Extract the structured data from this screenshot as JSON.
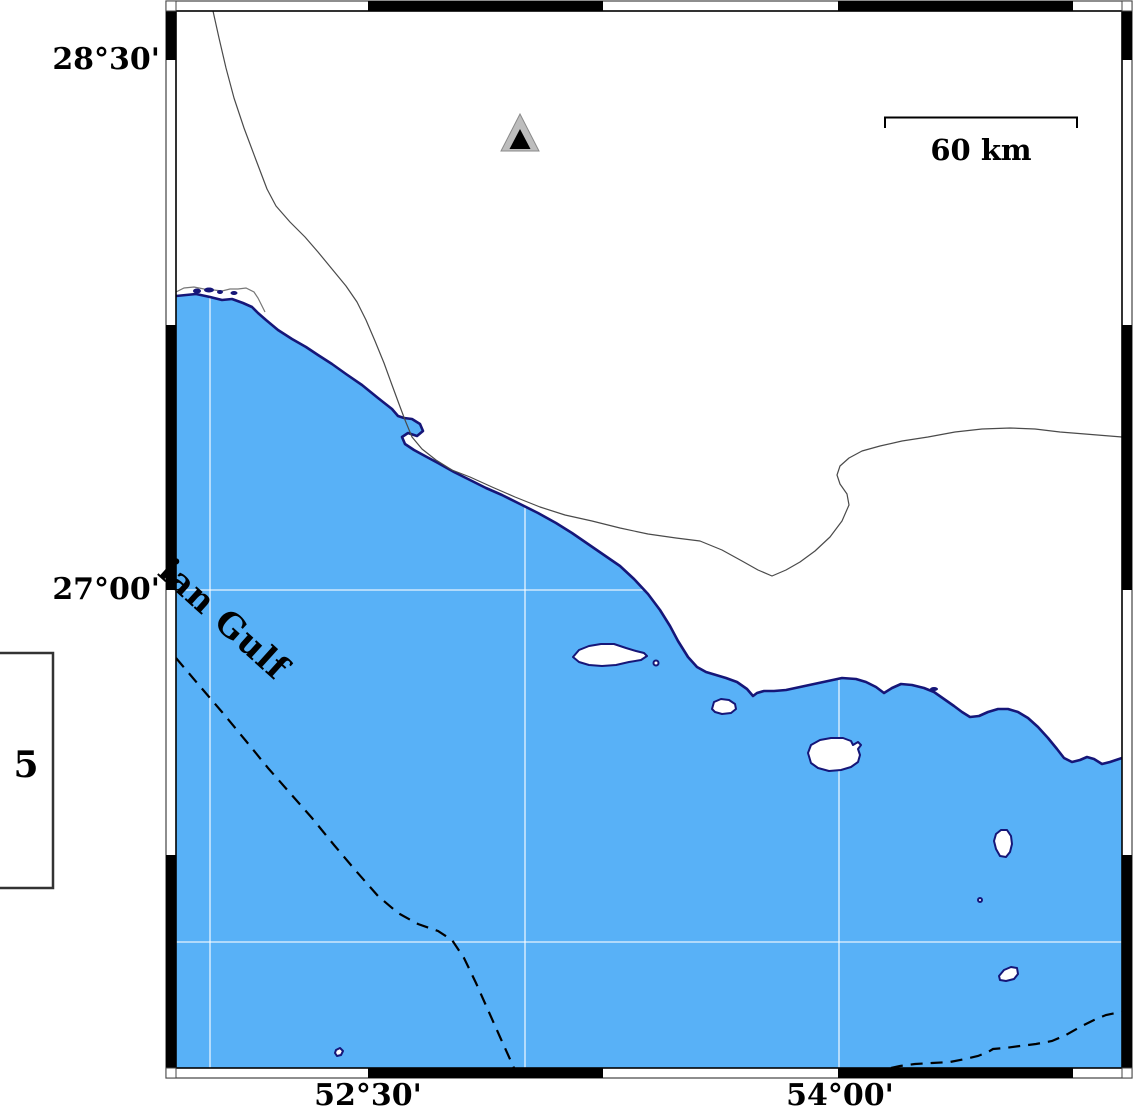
{
  "frame": {
    "lat_labels": [
      {
        "text": "28°30'"
      },
      {
        "text": "27°00'"
      }
    ],
    "lon_labels": [
      {
        "text": "52°30'"
      },
      {
        "text": "54°00'"
      }
    ]
  },
  "sea": {
    "name_label": "ian Gulf"
  },
  "scale_bar": {
    "label": "60 km"
  },
  "legend": {
    "value": "5"
  },
  "marker": {
    "kind": "station-triangle"
  },
  "colors": {
    "sea": "#58B1F7",
    "coastline": "#161678",
    "land": "#ffffff",
    "gridline": "rgba(255,255,255,0.85)",
    "frame_black": "#000000",
    "thin_line": "#4a4a4a",
    "marker_gray": "#bdbdbd",
    "marker_inner": "#000000"
  }
}
